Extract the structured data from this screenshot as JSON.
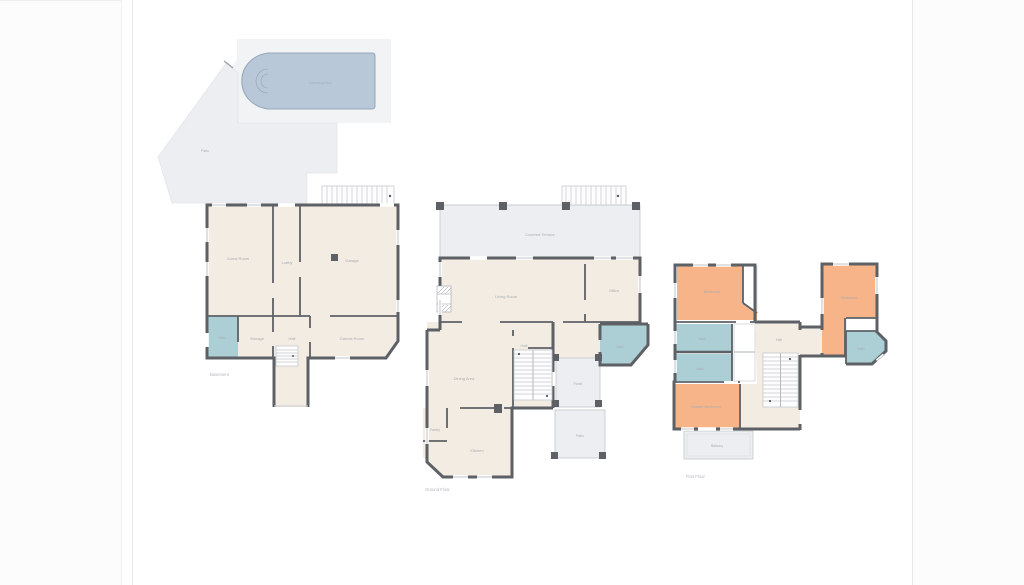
{
  "page": {
    "background": "#ffffff",
    "gutter_color": "#fcfcfd",
    "edge_line_color": "#e7e8e9"
  },
  "palette": {
    "wall": "#5d6166",
    "interior_floor": "#f2ece3",
    "outdoor_floor": "#eceef1",
    "pool_deck": "#f1f3f5",
    "pool_water": "#b9c8d8",
    "bathroom": "#accfd6",
    "bedroom": "#f6b488",
    "label_text": "#a9adb2"
  },
  "floors": [
    {
      "title": "Basement",
      "rooms": [
        {
          "name": "swimming-pool",
          "label": "Swimming Pool"
        },
        {
          "name": "patio",
          "label": "Patio"
        },
        {
          "name": "guest-room",
          "label": "Guest Room"
        },
        {
          "name": "lobby",
          "label": "Lobby"
        },
        {
          "name": "garage",
          "label": "Garage"
        },
        {
          "name": "bath",
          "label": "Bath"
        },
        {
          "name": "storage",
          "label": "Storage"
        },
        {
          "name": "hall",
          "label": "Hall"
        },
        {
          "name": "games-room",
          "label": "Games Room"
        }
      ]
    },
    {
      "title": "Ground Floor",
      "rooms": [
        {
          "name": "covered-terrace",
          "label": "Covered Terrace"
        },
        {
          "name": "living-room",
          "label": "Living Room"
        },
        {
          "name": "office",
          "label": "Office"
        },
        {
          "name": "hall",
          "label": "Hall"
        },
        {
          "name": "bath",
          "label": "Bath"
        },
        {
          "name": "porch",
          "label": "Porch"
        },
        {
          "name": "patio",
          "label": "Patio"
        },
        {
          "name": "dining-area",
          "label": "Dining Area"
        },
        {
          "name": "pantry",
          "label": "Pantry"
        },
        {
          "name": "kitchen",
          "label": "Kitchen"
        }
      ]
    },
    {
      "title": "First Floor",
      "rooms": [
        {
          "name": "bedroom-1",
          "label": "Bedroom"
        },
        {
          "name": "bath-1",
          "label": "Bath"
        },
        {
          "name": "bath-2",
          "label": "Bath"
        },
        {
          "name": "master-bedroom",
          "label": "Master Bedroom"
        },
        {
          "name": "balcony",
          "label": "Balcony"
        },
        {
          "name": "hall",
          "label": "Hall"
        },
        {
          "name": "bedroom-2",
          "label": "Bedroom"
        },
        {
          "name": "bath-3",
          "label": "Bath"
        }
      ]
    }
  ]
}
